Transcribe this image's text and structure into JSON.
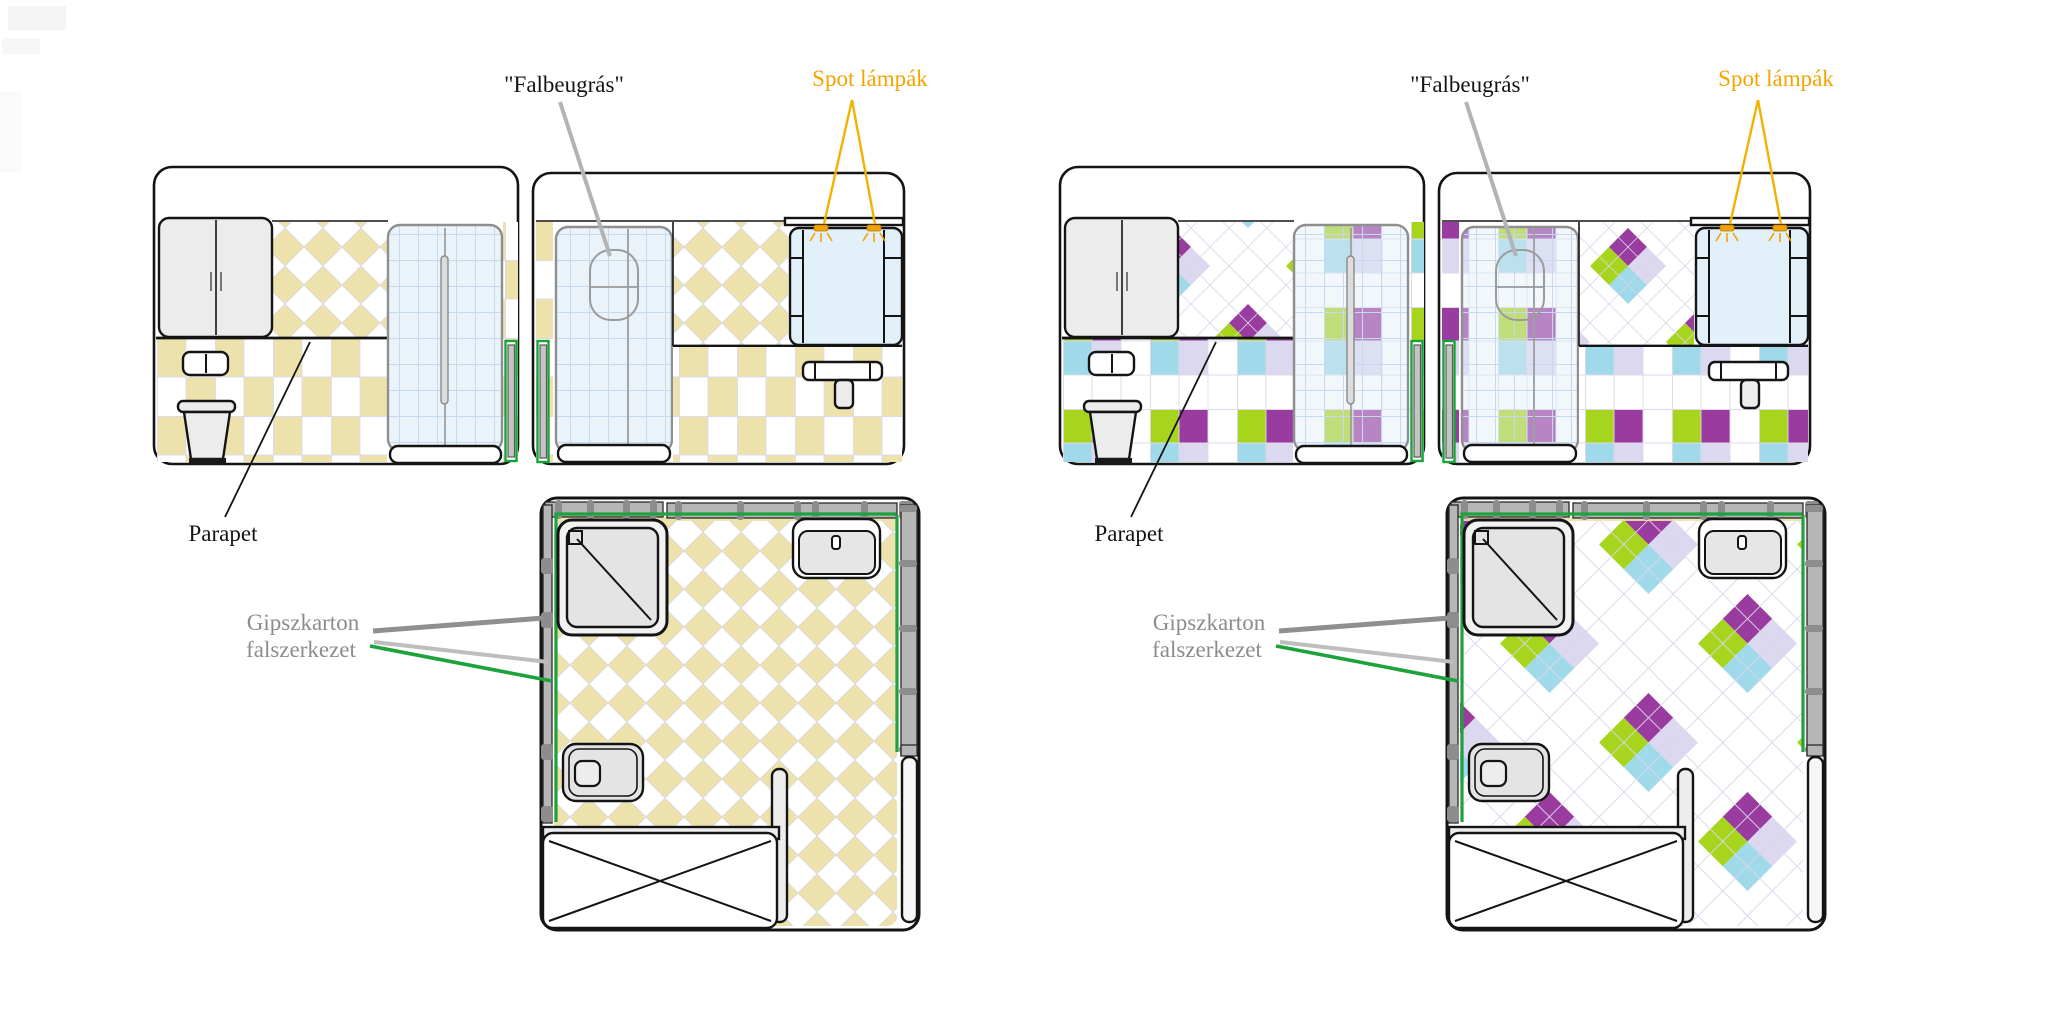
{
  "figure": {
    "title": "Bathroom renovation tile-scheme diagram",
    "background": "#ffffff"
  },
  "palette": {
    "beige_tile": "#EDE2AC",
    "purple_tile": "#9A3B9F",
    "green_tile": "#A7D51E",
    "blue_tile": "#A0D9E9",
    "lavender_tile": "#DBD8F0",
    "glass_blue": "#DFEBF7",
    "accent_green_line": "#1EA23C",
    "label_orange": "#F2A400",
    "label_gray": "#8C8C8C",
    "drywall_gray": "#B6B6B6"
  },
  "groups": {
    "left": {
      "scheme": "beige checkerboard tiles",
      "labels": {
        "falbeugras": "\"Falbeugrás\"",
        "spot_lampak": "Spot lámpák",
        "parapet": "Parapet",
        "gipszkarton1": "Gipszkarton",
        "gipszkarton2": "falszerkezet"
      }
    },
    "right": {
      "scheme": "multicolor argyle tiles",
      "labels": {
        "falbeugras": "\"Falbeugrás\"",
        "spot_lampak": "Spot lámpák",
        "parapet": "Parapet",
        "gipszkarton1": "Gipszkarton",
        "gipszkarton2": "falszerkezet"
      }
    }
  }
}
